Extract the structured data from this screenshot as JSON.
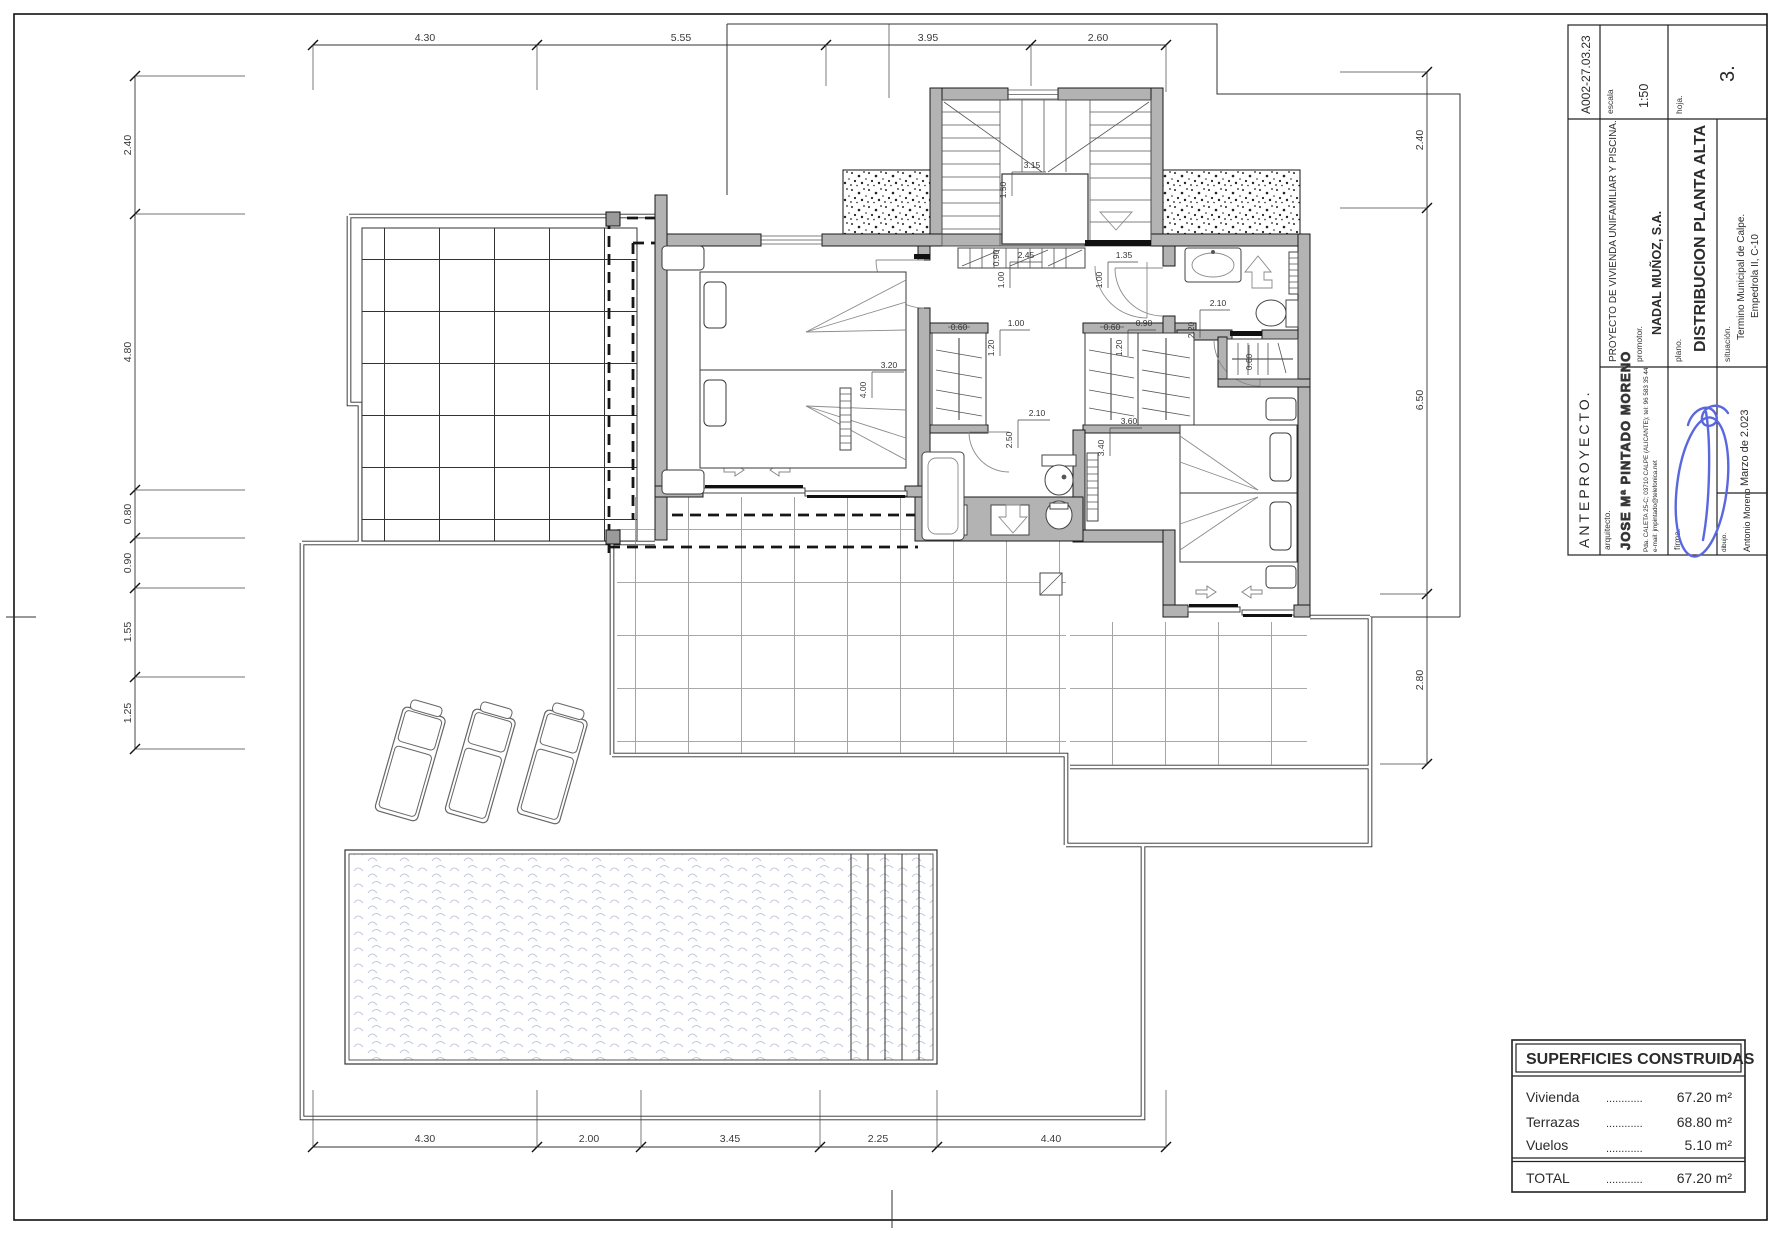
{
  "title_block": {
    "code": "A002-27.03.23",
    "escala_label": "escala",
    "escala_value": "1:50",
    "hoja_label": "hoja.",
    "hoja_value": "3.",
    "project": "PROYECTO DE VIVIENDA UNIFAMILIAR Y PISCINA.",
    "promotor_label": "promotor.",
    "promotor_value": "NADAL MUÑOZ, S.A.",
    "plano_label": "plano.",
    "plano_value": "DISTRIBUCION PLANTA ALTA",
    "situacion_label": "situación.",
    "situacion_line1": "Termino Municipal de Calpe.",
    "situacion_line2": "Empedrola II, C-10",
    "stage": "ANTEPROYECTO.",
    "arquitecto_label": "arquitecto.",
    "architect": "JOSE Mª PINTADO MORENO",
    "address": "Pda. CALETA 25-C; 03710 CALPE (ALICANTE); tel: 96 583 35 44.",
    "email": "e-mail: jmpintado@telefonica.net",
    "firma_label": "firma.",
    "date": "Marzo de 2.023",
    "dibujo_label": "dibujo.",
    "dibujo_value": "Antonio Moreno"
  },
  "areas_table": {
    "title": "SUPERFICIES CONSTRUIDAS",
    "rows": [
      {
        "label": "Vivienda",
        "dots": "............",
        "value": "67.20 m²"
      },
      {
        "label": "Terrazas",
        "dots": "............",
        "value": "68.80 m²"
      },
      {
        "label": "Vuelos",
        "dots": "............",
        "value": "5.10 m²"
      }
    ],
    "total_label": "TOTAL",
    "total_dots": "............",
    "total_value": "67.20 m²"
  },
  "dims": {
    "top": [
      "4.30",
      "5.55",
      "3.95",
      "2.60"
    ],
    "bottom": [
      "4.30",
      "2.00",
      "3.45",
      "2.25",
      "4.40"
    ],
    "left": [
      "2.40",
      "4.80",
      "0.80",
      "0.90",
      "1.55",
      "1.25"
    ],
    "right": [
      "2.40",
      "6.50",
      "2.80"
    ],
    "interior": [
      "3.15",
      "1.50",
      "0.90",
      "2.45",
      "1.00",
      "1.35",
      "1.00",
      "3.20",
      "4.00",
      "1.00",
      "1.20",
      "0.60",
      "0.60",
      "0.90",
      "1.20",
      "2.10",
      "2.50",
      "3.60",
      "3.40",
      "2.10",
      "2.20",
      "0.60"
    ]
  },
  "colors": {
    "wall_gray": "#b3b3b3",
    "signature_blue": "#5a68e0",
    "pool_wave": "#c3c9dd"
  }
}
